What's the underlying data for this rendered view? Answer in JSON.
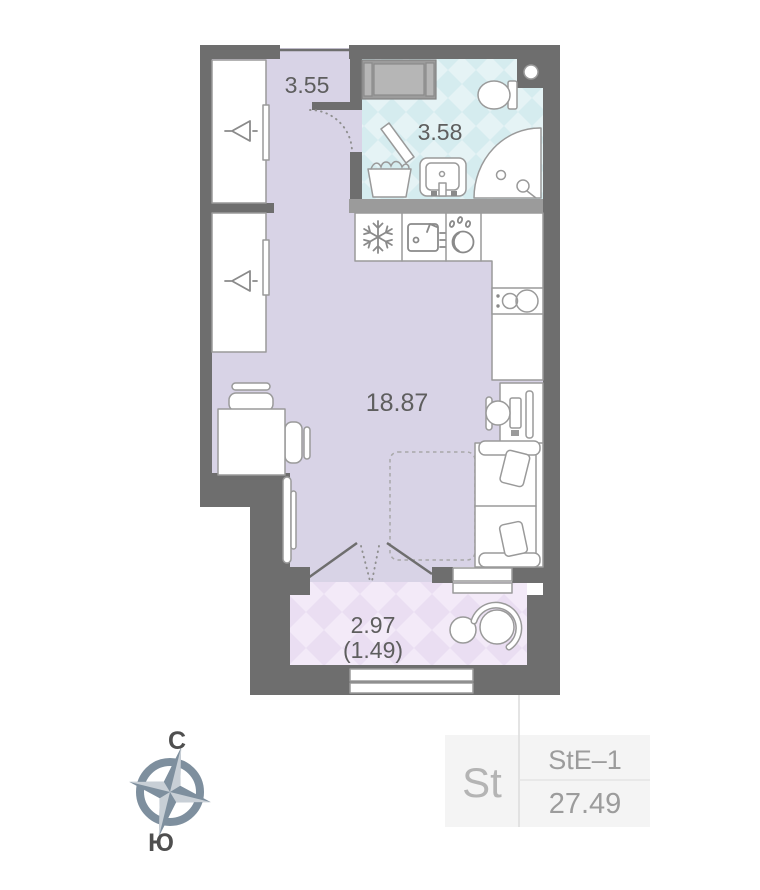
{
  "theme": {
    "wall": "#6e6e6e",
    "wall-light": "#9b9b9b",
    "floor": "#d8d3e6",
    "bath-base": "#d5ecef",
    "bath-diamond": "#e5f3f5",
    "balcony-base": "#eadef2",
    "balcony-diamond": "#f3eaf8",
    "furn-stroke": "#9a9a9a",
    "furn-fill": "#ffffff",
    "label": "#5e5e5e",
    "panel-bg": "#f4f4f4",
    "panel-text": "#9c9c9c",
    "panel-accent": "#b4b4b4",
    "panel-line": "#dcdcdc",
    "compass-body": "#7e8f9e",
    "compass-light": "#c8cfd6",
    "compass-letter": "#4f4f4f"
  },
  "floorplan": {
    "rooms": [
      {
        "name": "hallway",
        "area": "3.55"
      },
      {
        "name": "bathroom",
        "area": "3.58"
      },
      {
        "name": "living-room",
        "area": "18.87"
      },
      {
        "name": "balcony",
        "area": "2.97",
        "area_reduced": "(1.49)"
      }
    ]
  },
  "compass": {
    "north": "С",
    "south": "Ю"
  },
  "info_panel": {
    "type": "St",
    "layout_code": "StE–1",
    "total_area": "27.49"
  }
}
